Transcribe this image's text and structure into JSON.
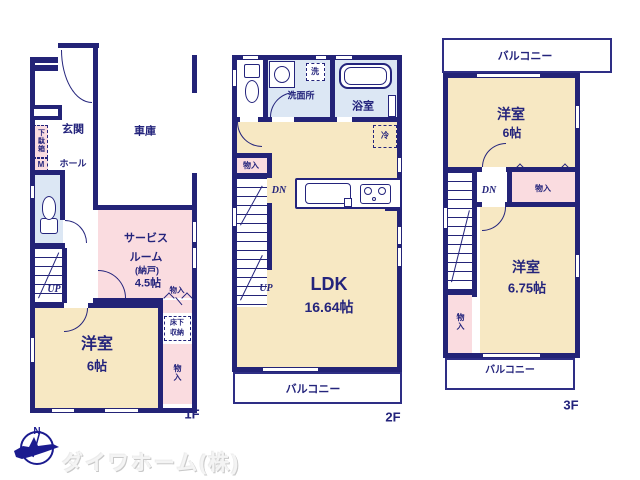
{
  "colors": {
    "wall": "#232377",
    "ink": "#24247c",
    "cream": "#f7e8c3",
    "pink": "#fadce0",
    "blue": "#dce7f4",
    "balc": "#2e2e85",
    "logo": "#1b1b8f"
  },
  "f1": {
    "floor_label": "1F",
    "genkan": "玄関",
    "garage": "車庫",
    "getabako": "下駄箱",
    "meter": "M",
    "hall": "ホール",
    "service_1": "サービス",
    "service_2": "ルーム",
    "service_3": "(納戸)",
    "service_4": "4.5帖",
    "up": "UP",
    "monoire": "物入",
    "yukashita_1": "床下",
    "yukashita_2": "収納",
    "yoshitsu": "洋室",
    "yoshitsu_size": "6帖",
    "monoire_v": "物入"
  },
  "f2": {
    "floor_label": "2F",
    "senmenjo": "洗面所",
    "sen": "洗",
    "yokushitsu": "浴室",
    "rei": "冷",
    "monoire": "物入",
    "dn": "DN",
    "up": "UP",
    "ldk": "LDK",
    "ldk_size": "16.64帖",
    "balcony": "バルコニー"
  },
  "f3": {
    "floor_label": "3F",
    "balcony_top": "バルコニー",
    "yoshitsu6": "洋室",
    "yoshitsu6_size": "6帖",
    "dn": "DN",
    "monoire_top": "物入",
    "yoshitsu675": "洋室",
    "yoshitsu675_size": "6.75帖",
    "monoire_v": "物入",
    "balcony_bottom": "バルコニー"
  },
  "footer": {
    "company": "ダイワホーム(株)",
    "compass_n": "N"
  }
}
